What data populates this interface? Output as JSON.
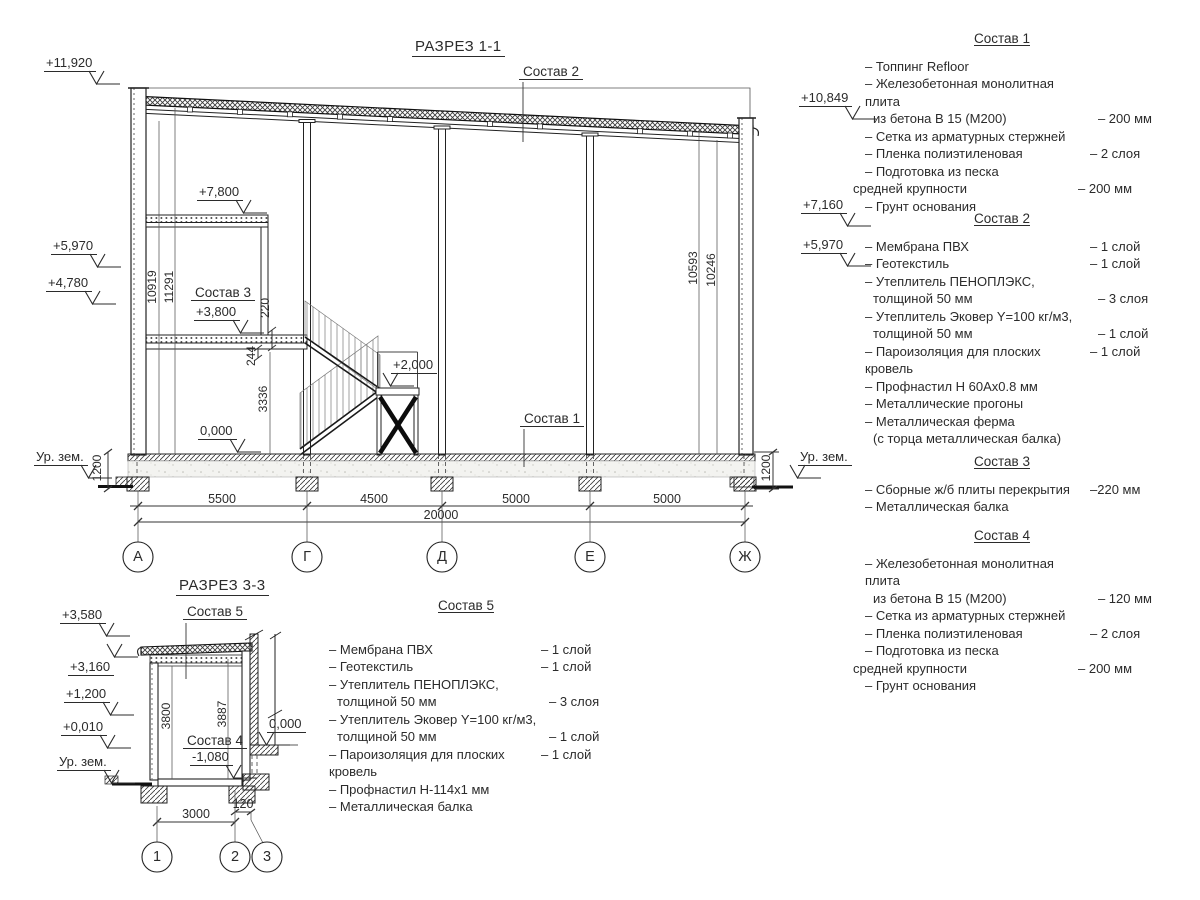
{
  "colors": {
    "line": "#222222",
    "text": "#2b2b2b"
  },
  "titles": [
    {
      "t": "РАЗРЕЗ 1-1",
      "x": 412,
      "y": 38
    },
    {
      "t": "РАЗРЕЗ 3-3",
      "x": 176,
      "y": 577
    }
  ],
  "annotations": {
    "elevations": [
      {
        "t": "+11,920",
        "x": 44,
        "y": 55
      },
      {
        "t": "+7,800",
        "x": 197,
        "y": 184
      },
      {
        "t": "+5,970",
        "x": 51,
        "y": 238
      },
      {
        "t": "+4,780",
        "x": 46,
        "y": 275
      },
      {
        "t": "+3,800",
        "x": 194,
        "y": 304
      },
      {
        "t": "0,000",
        "x": 198,
        "y": 423
      },
      {
        "t": "+2,000",
        "x": 391,
        "y": 357,
        "m": "flip"
      },
      {
        "t": "Ур. зем.",
        "x": 34,
        "y": 449
      },
      {
        "t": "Ур. зем.",
        "x": 798,
        "y": 449,
        "m": "flip"
      },
      {
        "t": "+10,849",
        "x": 799,
        "y": 90
      },
      {
        "t": "+7,160",
        "x": 801,
        "y": 197
      },
      {
        "t": "+5,970",
        "x": 801,
        "y": 237
      },
      {
        "t": "+3,580",
        "x": 60,
        "y": 607
      },
      {
        "t": "+3,160",
        "x": 68,
        "y": 659,
        "m": "up"
      },
      {
        "t": "+1,200",
        "x": 64,
        "y": 686
      },
      {
        "t": "+0,010",
        "x": 61,
        "y": 719
      },
      {
        "t": "Ур. зем.",
        "x": 57,
        "y": 754
      },
      {
        "t": "0,000",
        "x": 267,
        "y": 716,
        "m": "flip"
      },
      {
        "t": "-1,080",
        "x": 190,
        "y": 749
      }
    ],
    "labels": [
      {
        "t": "Состав 2",
        "x": 519,
        "y": 64
      },
      {
        "t": "Состав 1",
        "x": 520,
        "y": 411
      },
      {
        "t": "Состав 3",
        "x": 191,
        "y": 285
      },
      {
        "t": "Состав 5",
        "x": 183,
        "y": 604
      },
      {
        "t": "Состав 4",
        "x": 183,
        "y": 733
      }
    ],
    "dims": [
      {
        "t": "5500",
        "x": 222,
        "y": 492
      },
      {
        "t": "4500",
        "x": 374,
        "y": 492
      },
      {
        "t": "5000",
        "x": 516,
        "y": 492
      },
      {
        "t": "5000",
        "x": 667,
        "y": 492
      },
      {
        "t": "20000",
        "x": 441,
        "y": 508
      },
      {
        "t": "3000",
        "x": 196,
        "y": 807
      },
      {
        "t": "120",
        "x": 243,
        "y": 797
      }
    ],
    "rot_dims": [
      {
        "t": "10919",
        "x": 152,
        "y": 287
      },
      {
        "t": "11291",
        "x": 169,
        "y": 287
      },
      {
        "t": "10593",
        "x": 693,
        "y": 268
      },
      {
        "t": "10246",
        "x": 711,
        "y": 270
      },
      {
        "t": "1200",
        "x": 97,
        "y": 468
      },
      {
        "t": "1200",
        "x": 766,
        "y": 468
      },
      {
        "t": "220",
        "x": 265,
        "y": 308
      },
      {
        "t": "244",
        "x": 251,
        "y": 356
      },
      {
        "t": "3336",
        "x": 263,
        "y": 399
      },
      {
        "t": "3800",
        "x": 166,
        "y": 716
      },
      {
        "t": "3887",
        "x": 222,
        "y": 714
      }
    ],
    "axes": [
      {
        "t": "А",
        "x": 138,
        "y": 557
      },
      {
        "t": "Г",
        "x": 307,
        "y": 557
      },
      {
        "t": "Д",
        "x": 442,
        "y": 557
      },
      {
        "t": "Е",
        "x": 590,
        "y": 557
      },
      {
        "t": "Ж",
        "x": 745,
        "y": 557
      },
      {
        "t": "1",
        "x": 157,
        "y": 857
      },
      {
        "t": "2",
        "x": 235,
        "y": 857
      },
      {
        "t": "3",
        "x": 267,
        "y": 857
      }
    ]
  },
  "compositions": [
    {
      "title": "Состав 1",
      "items": [
        {
          "t": "– Топпинг Refloor"
        },
        {
          "t": "– Железобетонная  монолитная плита"
        },
        {
          "t": "из бетона В 15 (М200)",
          "v": "– 200 мм",
          "ind": 1
        },
        {
          "t": "– Сетка из арматурных стержней"
        },
        {
          "t": "– Пленка полиэтиленовая",
          "v": "– 2 слоя"
        },
        {
          "t": "– Подготовка из песка"
        },
        {
          "t": "средней крупности",
          "v": "– 200 мм",
          "ind": 2
        },
        {
          "t": "– Грунт основания"
        }
      ]
    },
    {
      "title": "Состав 2",
      "items": [
        {
          "t": "– Мембрана ПВХ",
          "v": "– 1 слой"
        },
        {
          "t": "– Геотекстиль",
          "v": "– 1 слой"
        },
        {
          "t": "– Утеплитель ПЕНОПЛЭКС,"
        },
        {
          "t": "толщиной 50 мм",
          "v": "– 3 слоя",
          "ind": 1
        },
        {
          "t": "– Утеплитель Эковер Y=100 кг/м3,"
        },
        {
          "t": "толщиной 50 мм",
          "v": "– 1 слой",
          "ind": 1
        },
        {
          "t": "– Пароизоляция для плоских кровель",
          "v": "– 1 слой"
        },
        {
          "t": "– Профнастил Н 60Ах0.8 мм"
        },
        {
          "t": "– Металлические прогоны"
        },
        {
          "t": "– Металлическая ферма"
        },
        {
          "t": "(с торца металлическая балка)",
          "ind": 1
        }
      ]
    },
    {
      "title": "Состав 3",
      "items": [
        {
          "t": "– Сборные ж/б плиты перекрытия",
          "v": "–220 мм"
        },
        {
          "t": "– Металлическая балка"
        }
      ]
    },
    {
      "title": "Состав 4",
      "items": [
        {
          "t": "– Железобетонная  монолитная плита"
        },
        {
          "t": "из бетона В 15 (М200)",
          "v": "– 120 мм",
          "ind": 1
        },
        {
          "t": "– Сетка из арматурных стержней"
        },
        {
          "t": "– Пленка полиэтиленовая",
          "v": "– 2 слоя"
        },
        {
          "t": "– Подготовка из песка"
        },
        {
          "t": "средней крупности",
          "v": "– 200 мм",
          "ind": 2
        },
        {
          "t": "– Грунт основания"
        }
      ]
    },
    {
      "title": "Состав 5",
      "items": [
        {
          "t": "– Мембрана ПВХ",
          "v": "– 1 слой"
        },
        {
          "t": "– Геотекстиль",
          "v": "– 1 слой"
        },
        {
          "t": "– Утеплитель ПЕНОПЛЭКС,"
        },
        {
          "t": "толщиной 50 мм",
          "v": "– 3 слоя",
          "ind": 1
        },
        {
          "t": "– Утеплитель Эковер Y=100 кг/м3,"
        },
        {
          "t": "толщиной 50 мм",
          "v": "– 1 слой",
          "ind": 1
        },
        {
          "t": "– Пароизоляция для плоских кровель",
          "v": "– 1 слой"
        },
        {
          "t": "– Профнастил Н-114х1 мм"
        },
        {
          "t": "– Металлическая балка"
        }
      ]
    }
  ]
}
